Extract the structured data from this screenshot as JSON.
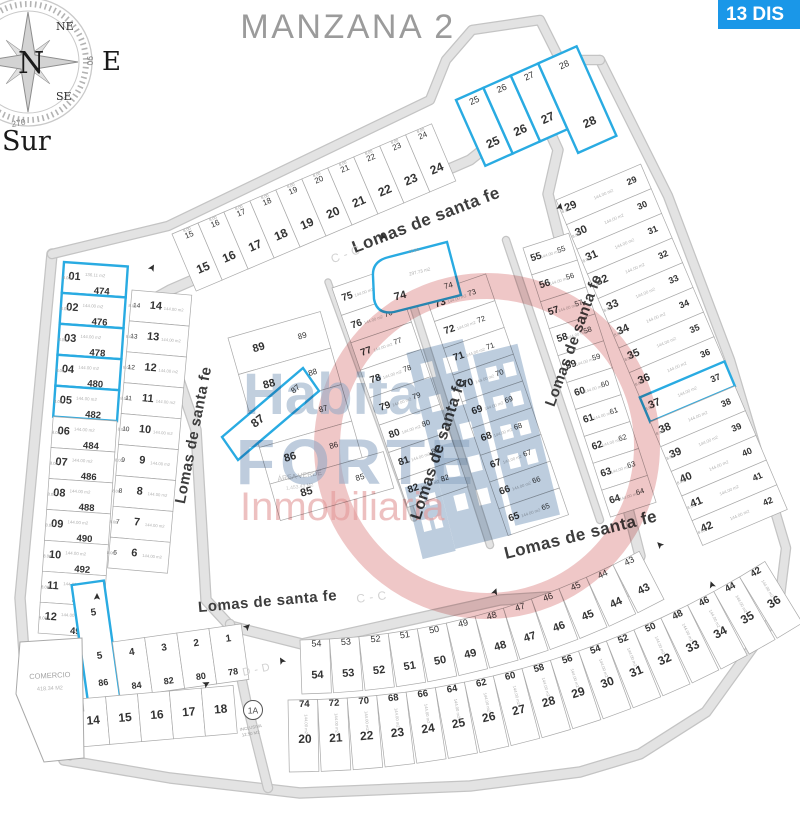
{
  "title": "MANZANA 2",
  "badge": {
    "text": "13 DIS"
  },
  "compass": {
    "n": "N",
    "ne": "NE",
    "se": "SE",
    "e": "E",
    "s": "Sur",
    "deg_bottom": "270",
    "deg_right": "90"
  },
  "watermark": {
    "line1": "Habita",
    "line2": "FORTE",
    "line3": "Inmobiliaria"
  },
  "theme": {
    "available_blue": "#29abe2",
    "badge_bg": "#1a97e8",
    "title_gray": "#9b9b9b",
    "road_gray": "#d6d6d6",
    "lot_border": "#a9a9a9",
    "number_dark": "#333333",
    "watermark_blue": "#8fa8c4",
    "watermark_red": "#e39a9a"
  },
  "map": {
    "lot_area_label": "144.00 m2",
    "dim_labels": [
      "8.00",
      "18.00"
    ],
    "streets": [
      {
        "id": "lsf-north",
        "text": "Lomas de santa fe"
      },
      {
        "id": "cc-north",
        "text": "C - C"
      },
      {
        "id": "lsf-west",
        "text": "Lomas de santa fe"
      },
      {
        "id": "lsf-center",
        "text": "Lomas de santa fe"
      },
      {
        "id": "lsf-east",
        "text": "Lomas de santa fe"
      },
      {
        "id": "lsf-southeast",
        "text": "Lomas de santa fe"
      },
      {
        "id": "lsf-south",
        "text": "Lomas de santa fe"
      },
      {
        "id": "cc-south",
        "text": "C - C"
      },
      {
        "id": "dd-south",
        "text": "D - D"
      }
    ],
    "blocks": [
      {
        "id": "west-column",
        "lots": [
          "01",
          "02",
          "03",
          "04",
          "05",
          "06",
          "07",
          "08",
          "09",
          "10",
          "11",
          "12"
        ],
        "addresses": [
          "474",
          "476",
          "478",
          "480",
          "482",
          "484",
          "486",
          "488",
          "490",
          "492",
          "494",
          "496"
        ],
        "available": [
          "01",
          "02",
          "03",
          "04",
          "05"
        ],
        "areas": {
          "01": "136.11 m2"
        }
      },
      {
        "id": "west-inner-column",
        "lots": [
          "14",
          "13",
          "12",
          "11",
          "10",
          "9",
          "8",
          "7",
          "6"
        ]
      },
      {
        "id": "north-row",
        "lots": [
          "15",
          "16",
          "17",
          "18",
          "19",
          "20",
          "21",
          "22",
          "23",
          "24"
        ]
      },
      {
        "id": "north-blue-row",
        "lots": [
          "25",
          "26",
          "27",
          "28"
        ],
        "available": [
          "25",
          "26",
          "27",
          "28"
        ]
      },
      {
        "id": "east-column",
        "lots": [
          "29",
          "30",
          "31",
          "32",
          "33",
          "34",
          "35",
          "36",
          "37",
          "38",
          "39",
          "40",
          "41",
          "42"
        ],
        "available": [
          "37"
        ]
      },
      {
        "id": "center-strip-1",
        "lots": [
          "89",
          "88",
          "87",
          "86",
          "85"
        ]
      },
      {
        "id": "center-strip-2",
        "lots": [
          "75",
          "76",
          "77",
          "78",
          "79",
          "80",
          "81",
          "82"
        ]
      },
      {
        "id": "center-strip-3",
        "lots": [
          "74",
          "73",
          "72",
          "71",
          "70",
          "69",
          "68",
          "67",
          "66",
          "65"
        ]
      },
      {
        "id": "center-strip-4",
        "lots": [
          "55",
          "56",
          "57",
          "58",
          "59",
          "60",
          "61",
          "62",
          "63",
          "64"
        ]
      },
      {
        "id": "south-row-upper",
        "lots": [
          "54",
          "53",
          "52",
          "51",
          "50",
          "49",
          "48",
          "47",
          "46",
          "45",
          "44",
          "43"
        ]
      },
      {
        "id": "south-row-lower",
        "lots": [
          "20",
          "21",
          "22",
          "23",
          "24",
          "25",
          "26",
          "27",
          "28",
          "29",
          "30",
          "31",
          "32",
          "33",
          "34",
          "35",
          "36"
        ],
        "addresses": [
          "74",
          "72",
          "70",
          "68",
          "66",
          "64",
          "62",
          "60",
          "58",
          "56",
          "54",
          "52",
          "50",
          "48",
          "46",
          "44",
          "42"
        ]
      },
      {
        "id": "southwest-upper",
        "lots": [
          "5",
          "4",
          "3",
          "2",
          "1"
        ],
        "addresses": [
          "86",
          "84",
          "82",
          "80",
          "78"
        ],
        "available": [
          "5"
        ]
      },
      {
        "id": "southwest-lower",
        "lots": [
          "13",
          "14",
          "15",
          "16",
          "17",
          "18"
        ]
      },
      {
        "id": "southwest-left",
        "lots": [
          "88"
        ]
      }
    ],
    "specials": [
      {
        "id": "lot-74",
        "labels": [
          "74",
          "74",
          "297.73 m2",
          "15.96"
        ],
        "available": true
      },
      {
        "id": "lot-87",
        "labels": [
          "87",
          "87"
        ],
        "available": true
      },
      {
        "id": "comercio",
        "labels": [
          "COMERCIO",
          "418.34 M2"
        ]
      },
      {
        "id": "area-verde",
        "labels": [
          "ÁREA VERDE",
          "1,453.43 M2"
        ]
      },
      {
        "id": "inclusive-lot",
        "labels": [
          "1A",
          "INCLUSIVA",
          "12.50 M2"
        ]
      }
    ]
  }
}
